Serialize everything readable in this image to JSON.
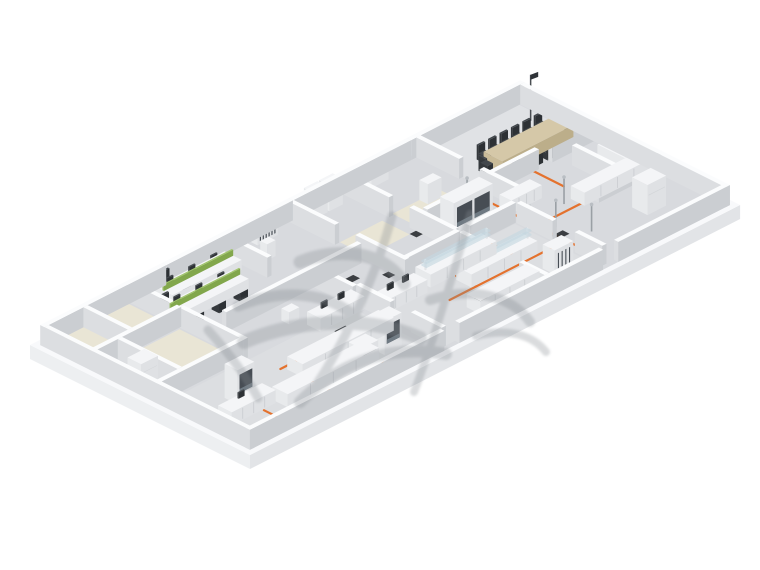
{
  "meta": {
    "title": "isometric-laboratory-office-floorplan-render",
    "description": "3D isometric architectural render of a long rectangular laboratory and office floor with white slab, gray partition walls, lab benches, fume hoods, office desks with green divider screens, a conference room, orange utility routing lines on the floor and a translucent gray calligraphic watermark overlay."
  },
  "canvas": {
    "width": 760,
    "height": 570,
    "background": "#ffffff"
  },
  "scene": {
    "projection": {
      "origin": [
        30,
        345
      ],
      "u_axis": [
        0.845,
        -0.431
      ],
      "v_axis": [
        0.856,
        0.428
      ],
      "building_u": 580,
      "building_v": 257,
      "wall_height": 20,
      "slab_thickness": 14
    },
    "palette": {
      "slabTop": "#f8f9fb",
      "slabSideU": "#edeff1",
      "slabSideV": "#e2e4e7",
      "floor": "#d8dade",
      "floorCool": "#dcdee1",
      "floorLight": "#e0e2e5",
      "beige": "#e9e5d5",
      "wall": {
        "top": "#fbfcfd",
        "u": "#dcdee1",
        "v": "#cbced2"
      },
      "white": {
        "top": "#f4f5f7",
        "u": "#e8eaec",
        "v": "#dfe1e4"
      },
      "tan": {
        "top": "#d5c8a8",
        "u": "#c9bb98",
        "v": "#bcae8a"
      },
      "green": {
        "top": "#a0c46a",
        "u": "#8fb455",
        "v": "#82a74c"
      },
      "dark": {
        "top": "#43484d",
        "u": "#35393d",
        "v": "#2d3135"
      },
      "glass": "rgba(198,216,224,0.66)",
      "window": "#474d54",
      "windowLite": "#6f7a83",
      "seam": "#c9ccd0",
      "fridgeSeam": "#d3d6d9",
      "orange": "#e4722e",
      "mat": "#2e3134",
      "postGray": "#9aa0a5",
      "postHead": "#b9bec3",
      "pole": "#4a4e53",
      "flag": "#2f3338",
      "watermark": "#868c92"
    },
    "floors": [
      {
        "u": 6,
        "v": 6,
        "w": 568,
        "d": 245,
        "c": "floor"
      },
      {
        "u": 240,
        "v": 146,
        "w": 186,
        "d": 100,
        "c": "floorCool"
      },
      {
        "u": 28,
        "v": 146,
        "w": 204,
        "d": 100,
        "c": "floorCool"
      },
      {
        "u": 450,
        "v": 11,
        "w": 118,
        "d": 78,
        "c": "floorLight"
      },
      {
        "u": 10,
        "v": 11,
        "w": 96,
        "d": 51,
        "c": "beige"
      },
      {
        "u": 40,
        "v": 70,
        "w": 66,
        "d": 64,
        "c": "beige"
      },
      {
        "u": 366,
        "v": 62,
        "w": 56,
        "d": 38,
        "c": "beige"
      },
      {
        "u": 302,
        "v": 64,
        "w": 50,
        "d": 32,
        "c": "beige"
      }
    ],
    "walls": [
      [
        6,
        6,
        144,
        5
      ],
      [
        150,
        6,
        150,
        5
      ],
      [
        300,
        6,
        140,
        5
      ],
      [
        440,
        6,
        134,
        5
      ],
      [
        6,
        11,
        5,
        240
      ],
      [
        569,
        11,
        5,
        240
      ],
      [
        6,
        246,
        230,
        5
      ],
      [
        254,
        246,
        170,
        5
      ],
      [
        442,
        246,
        132,
        5
      ],
      [
        52,
        11,
        5,
        52
      ],
      [
        6,
        63,
        104,
        5
      ],
      [
        108,
        11,
        5,
        52
      ],
      [
        35,
        68,
        5,
        70
      ],
      [
        6,
        138,
        102,
        5
      ],
      [
        108,
        68,
        5,
        75
      ],
      [
        218,
        11,
        5,
        51
      ],
      [
        130,
        96,
        160,
        5
      ],
      [
        234,
        101,
        5,
        45
      ],
      [
        296,
        11,
        5,
        53
      ],
      [
        296,
        88,
        5,
        58
      ],
      [
        360,
        11,
        5,
        53
      ],
      [
        360,
        88,
        5,
        52
      ],
      [
        238,
        146,
        5,
        40
      ],
      [
        238,
        210,
        5,
        36
      ],
      [
        296,
        140,
        66,
        5
      ],
      [
        374,
        140,
        54,
        5
      ],
      [
        368,
        96,
        60,
        5
      ],
      [
        360,
        146,
        5,
        46
      ],
      [
        360,
        216,
        5,
        30
      ],
      [
        446,
        11,
        5,
        50
      ],
      [
        446,
        85,
        5,
        55
      ],
      [
        446,
        92,
        58,
        5
      ],
      [
        520,
        92,
        54,
        5
      ],
      [
        428,
        146,
        5,
        42
      ],
      [
        428,
        214,
        5,
        32
      ],
      [
        500,
        166,
        74,
        5
      ],
      [
        528,
        112,
        5,
        54
      ]
    ],
    "objects": [
      {
        "t": "desk",
        "u": 130,
        "v": 18,
        "w": 82,
        "d": 20
      },
      {
        "t": "screen",
        "u": 130,
        "v": 26.5,
        "w": 82,
        "z": 10
      },
      {
        "t": "desk",
        "u": 112,
        "v": 44,
        "w": 82,
        "d": 20
      },
      {
        "t": "screen",
        "u": 112,
        "v": 52.5,
        "w": 82,
        "z": 10
      },
      {
        "t": "chair",
        "u": 146,
        "v": 9,
        "back": "minus-v"
      },
      {
        "t": "chair",
        "u": 172,
        "v": 9,
        "back": "minus-v"
      },
      {
        "t": "chair",
        "u": 198,
        "v": 9,
        "back": "minus-v"
      },
      {
        "t": "chair",
        "u": 150,
        "v": 39,
        "back": "plus-v"
      },
      {
        "t": "chair",
        "u": 176,
        "v": 39,
        "back": "plus-v"
      },
      {
        "t": "chair",
        "u": 118,
        "v": 36,
        "back": "minus-v"
      },
      {
        "t": "chair",
        "u": 144,
        "v": 36,
        "back": "minus-v"
      },
      {
        "t": "chair",
        "u": 122,
        "v": 66,
        "back": "plus-v"
      },
      {
        "t": "chair",
        "u": 148,
        "v": 66,
        "back": "plus-v"
      },
      {
        "t": "chair",
        "u": 174,
        "v": 66,
        "back": "plus-v"
      },
      {
        "t": "monitor",
        "u": 140,
        "v": 21,
        "z": 10
      },
      {
        "t": "monitor",
        "u": 166,
        "v": 21,
        "z": 10
      },
      {
        "t": "monitor",
        "u": 192,
        "v": 21,
        "z": 10
      },
      {
        "t": "monitor",
        "u": 122,
        "v": 47,
        "z": 10
      },
      {
        "t": "monitor",
        "u": 148,
        "v": 47,
        "z": 10
      },
      {
        "t": "monitor",
        "u": 174,
        "v": 47,
        "z": 10
      },
      {
        "t": "table",
        "u": 478,
        "v": 58,
        "w": 84,
        "d": 22
      },
      {
        "t": "chair",
        "u": 479,
        "v": 49,
        "back": "minus-v"
      },
      {
        "t": "chair",
        "u": 492.5,
        "v": 49,
        "back": "minus-v"
      },
      {
        "t": "chair",
        "u": 506,
        "v": 49,
        "back": "minus-v"
      },
      {
        "t": "chair",
        "u": 519.5,
        "v": 49,
        "back": "minus-v"
      },
      {
        "t": "chair",
        "u": 533,
        "v": 49,
        "back": "minus-v"
      },
      {
        "t": "chair",
        "u": 546.5,
        "v": 49,
        "back": "minus-v"
      },
      {
        "t": "chair",
        "u": 479,
        "v": 83,
        "back": "plus-v"
      },
      {
        "t": "chair",
        "u": 492.5,
        "v": 83,
        "back": "plus-v"
      },
      {
        "t": "chair",
        "u": 506,
        "v": 83,
        "back": "plus-v"
      },
      {
        "t": "chair",
        "u": 519.5,
        "v": 83,
        "back": "plus-v"
      },
      {
        "t": "chair",
        "u": 533,
        "v": 83,
        "back": "plus-v"
      },
      {
        "t": "chair",
        "u": 546.5,
        "v": 83,
        "back": "plus-v"
      },
      {
        "t": "chair",
        "u": 467,
        "v": 63,
        "back": "minus-u"
      },
      {
        "t": "chair",
        "u": 565,
        "v": 63,
        "back": "plus-u"
      },
      {
        "t": "fridge",
        "u": 12,
        "v": 102,
        "w": 20,
        "d": 16,
        "h": 26
      },
      {
        "t": "bench",
        "u": 122,
        "v": 180,
        "w": 108,
        "d": 18
      },
      {
        "t": "bench",
        "u": 78,
        "v": 206,
        "w": 108,
        "d": 18
      },
      {
        "t": "bench",
        "u": 24,
        "v": 196,
        "w": 52,
        "d": 16
      },
      {
        "t": "monitor",
        "u": 44,
        "v": 199,
        "z": 13
      },
      {
        "t": "hood",
        "u": 52,
        "v": 176,
        "w": 20,
        "d": 15,
        "h": 34,
        "win": 1
      },
      {
        "t": "hood",
        "u": 150,
        "v": 224,
        "w": 20,
        "d": 15,
        "h": 34,
        "win": 1
      },
      {
        "t": "hood",
        "u": 196,
        "v": 206,
        "w": 20,
        "d": 15,
        "h": 34,
        "win": 1
      },
      {
        "t": "bench",
        "u": 244,
        "v": 158,
        "w": 50,
        "d": 16
      },
      {
        "t": "monitor",
        "u": 258,
        "v": 162,
        "z": 13
      },
      {
        "t": "monitor",
        "u": 276,
        "v": 162,
        "z": 13
      },
      {
        "t": "bench",
        "u": 186,
        "v": 140,
        "w": 52,
        "d": 16
      },
      {
        "t": "monitor",
        "u": 198,
        "v": 144,
        "z": 13
      },
      {
        "t": "monitor",
        "u": 218,
        "v": 144,
        "z": 13
      },
      {
        "t": "box",
        "u": 314,
        "v": 10,
        "w": 16,
        "d": 12,
        "h": 26
      },
      {
        "t": "box",
        "u": 332,
        "v": 10,
        "w": 16,
        "d": 12,
        "h": 26
      },
      {
        "t": "locker",
        "u": 250,
        "v": 10,
        "w": 24,
        "d": 9,
        "h": 22,
        "slats": 6
      },
      {
        "t": "box",
        "u": 238,
        "v": 34,
        "w": 10,
        "d": 8,
        "h": 16
      },
      {
        "t": "box",
        "u": 384,
        "v": 10,
        "w": 20,
        "d": 10,
        "h": 14
      },
      {
        "t": "box",
        "u": 398,
        "v": 62,
        "w": 16,
        "d": 10,
        "h": 20
      },
      {
        "t": "glassbench",
        "u": 302,
        "v": 152,
        "w": 78,
        "d": 18
      },
      {
        "t": "glassbench",
        "u": 326,
        "v": 176,
        "w": 78,
        "d": 18
      },
      {
        "t": "hood",
        "u": 372,
        "v": 112,
        "w": 46,
        "d": 16,
        "h": 36,
        "win": 2
      },
      {
        "t": "locker",
        "u": 390,
        "v": 214,
        "w": 22,
        "d": 14,
        "h": 24,
        "slats": 4
      },
      {
        "t": "bench",
        "u": 300,
        "v": 214,
        "w": 70,
        "d": 16
      },
      {
        "t": "bench",
        "u": 488,
        "v": 150,
        "w": 78,
        "d": 16
      },
      {
        "t": "bench",
        "u": 552,
        "v": 118,
        "w": 16,
        "d": 32
      },
      {
        "t": "bench",
        "u": 436,
        "v": 118,
        "w": 36,
        "d": 14
      },
      {
        "t": "fridge",
        "u": 514,
        "v": 196,
        "w": 22,
        "d": 18,
        "h": 30
      },
      {
        "t": "post",
        "u": 446,
        "v": 174
      },
      {
        "t": "post",
        "u": 462,
        "v": 200
      },
      {
        "t": "post",
        "u": 478,
        "v": 152
      },
      {
        "t": "post",
        "u": 420,
        "v": 96
      },
      {
        "t": "flagpole",
        "u": 556,
        "v": 36
      },
      {
        "t": "box",
        "u": 176,
        "v": 120,
        "w": 12,
        "d": 9,
        "h": 12
      }
    ],
    "orange_lines": [
      [
        [
          35,
          236
        ],
        [
          245,
          236
        ]
      ],
      [
        [
          60,
          236
        ],
        [
          60,
          214
        ]
      ],
      [
        [
          122,
          236
        ],
        [
          122,
          200
        ]
      ],
      [
        [
          186,
          236
        ],
        [
          186,
          226
        ]
      ],
      [
        [
          118,
          176
        ],
        [
          240,
          176
        ]
      ],
      [
        [
          240,
          176
        ],
        [
          240,
          158
        ]
      ],
      [
        [
          298,
          196
        ],
        [
          428,
          196
        ]
      ],
      [
        [
          330,
          196
        ],
        [
          330,
          172
        ]
      ],
      [
        [
          388,
          196
        ],
        [
          388,
          152
        ]
      ],
      [
        [
          310,
          132
        ],
        [
          428,
          132
        ]
      ],
      [
        [
          436,
          102
        ],
        [
          436,
          232
        ]
      ],
      [
        [
          436,
          162
        ],
        [
          538,
          162
        ]
      ],
      [
        [
          498,
          132
        ],
        [
          498,
          96
        ]
      ],
      [
        [
          368,
          132
        ],
        [
          368,
          112
        ]
      ]
    ],
    "mats": [
      [
        258,
        110
      ],
      [
        288,
        127
      ],
      [
        194,
        164
      ],
      [
        310,
        208
      ],
      [
        433,
        182
      ],
      [
        352,
        96
      ]
    ],
    "watermark": {
      "opacity": 0.3,
      "strokes": [
        {
          "d": "M300,262 C340,246 386,252 404,284",
          "w": 13
        },
        {
          "d": "M392,216 C378,268 352,330 318,382",
          "w": 9
        },
        {
          "d": "M470,214 C456,266 434,340 414,392",
          "w": 8
        },
        {
          "d": "M238,306 C282,288 330,292 356,318",
          "w": 11
        },
        {
          "d": "M244,342 C300,318 370,316 420,338",
          "w": 14
        },
        {
          "d": "M300,402 C340,362 390,344 446,354",
          "w": 12
        },
        {
          "d": "M430,300 C472,286 512,296 530,322",
          "w": 10
        },
        {
          "d": "M476,336 C506,328 532,334 546,352",
          "w": 8
        },
        {
          "d": "M208,330 C228,352 246,376 258,398",
          "w": 9
        }
      ]
    }
  }
}
